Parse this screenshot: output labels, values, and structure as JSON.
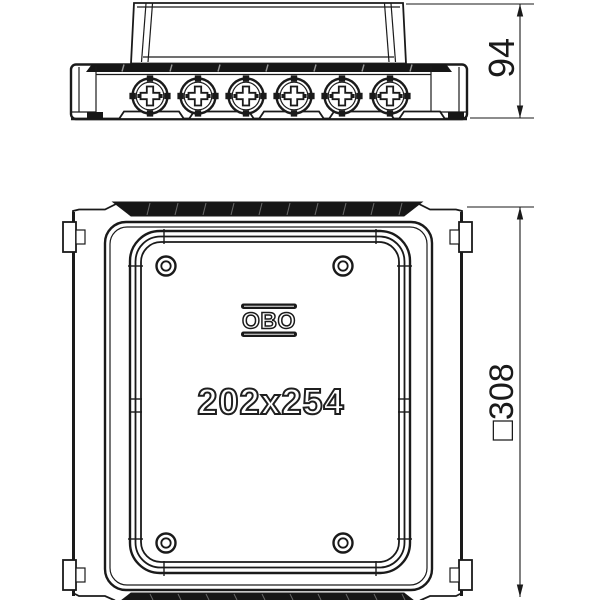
{
  "colors": {
    "background": "#ffffff",
    "line": "#1a1a1a",
    "band_fill": "#161616"
  },
  "views": {
    "side": {
      "dimension_height": "94"
    },
    "plan": {
      "dimension_outer": "□308",
      "inner_label": "202x254",
      "brand": "OBO"
    }
  }
}
